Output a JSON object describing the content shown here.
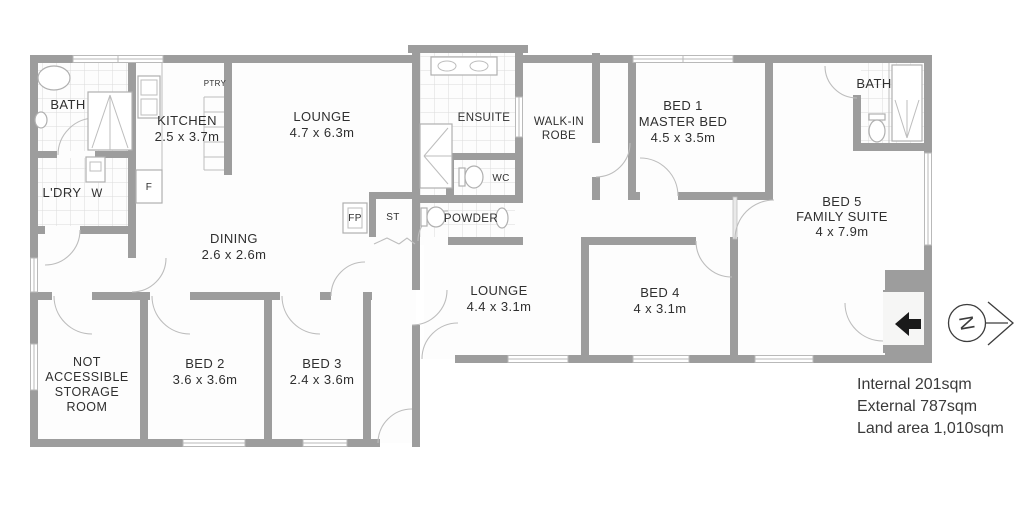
{
  "rooms": {
    "bath_left": {
      "label": "BATH"
    },
    "kitchen": {
      "label": "KITCHEN",
      "dims": "2.5 x 3.7m"
    },
    "pantry": {
      "label": "PTRY"
    },
    "laundry": {
      "label": "L'DRY"
    },
    "washer": {
      "label": "W"
    },
    "fridge": {
      "label": "F"
    },
    "lounge_main": {
      "label": "LOUNGE",
      "dims": "4.7 x 6.3m"
    },
    "dining": {
      "label": "DINING",
      "dims": "2.6 x 2.6m"
    },
    "fireplace": {
      "label": "FP"
    },
    "store_cupboard": {
      "label": "ST"
    },
    "ensuite": {
      "label": "ENSUITE"
    },
    "wc": {
      "label": "WC"
    },
    "powder": {
      "label": "POWDER"
    },
    "walk_in_robe": {
      "label_line1": "WALK-IN",
      "label_line2": "ROBE"
    },
    "bed_1": {
      "label_line1": "BED 1",
      "label_line2": "MASTER BED",
      "dims": "4.5 x 3.5m"
    },
    "bath_right": {
      "label": "BATH"
    },
    "bed_5": {
      "label_line1": "BED 5",
      "label_line2": "FAMILY SUITE",
      "dims": "4 x 7.9m"
    },
    "lounge_second": {
      "label": "LOUNGE",
      "dims": "4.4 x 3.1m"
    },
    "bed_4": {
      "label": "BED 4",
      "dims": "4 x 3.1m"
    },
    "storage_room": {
      "label_line1": "NOT",
      "label_line2": "ACCESSIBLE",
      "label_line3": "STORAGE",
      "label_line4": "ROOM"
    },
    "bed_2": {
      "label": "BED 2",
      "dims": "3.6 x 3.6m"
    },
    "bed_3": {
      "label": "BED 3",
      "dims": "2.4 x 3.6m"
    }
  },
  "area_summary": {
    "internal": "Internal 201sqm",
    "external": "External 787sqm",
    "land": "Land area 1,010sqm"
  },
  "compass": {
    "north_label": "N"
  },
  "colors": {
    "wall": "#9d9d9d",
    "tile_line": "#dcdcdc",
    "door_arc": "#bdbdbd",
    "text": "#2f2f2f",
    "entry_arrow": "#1a1a1a"
  }
}
